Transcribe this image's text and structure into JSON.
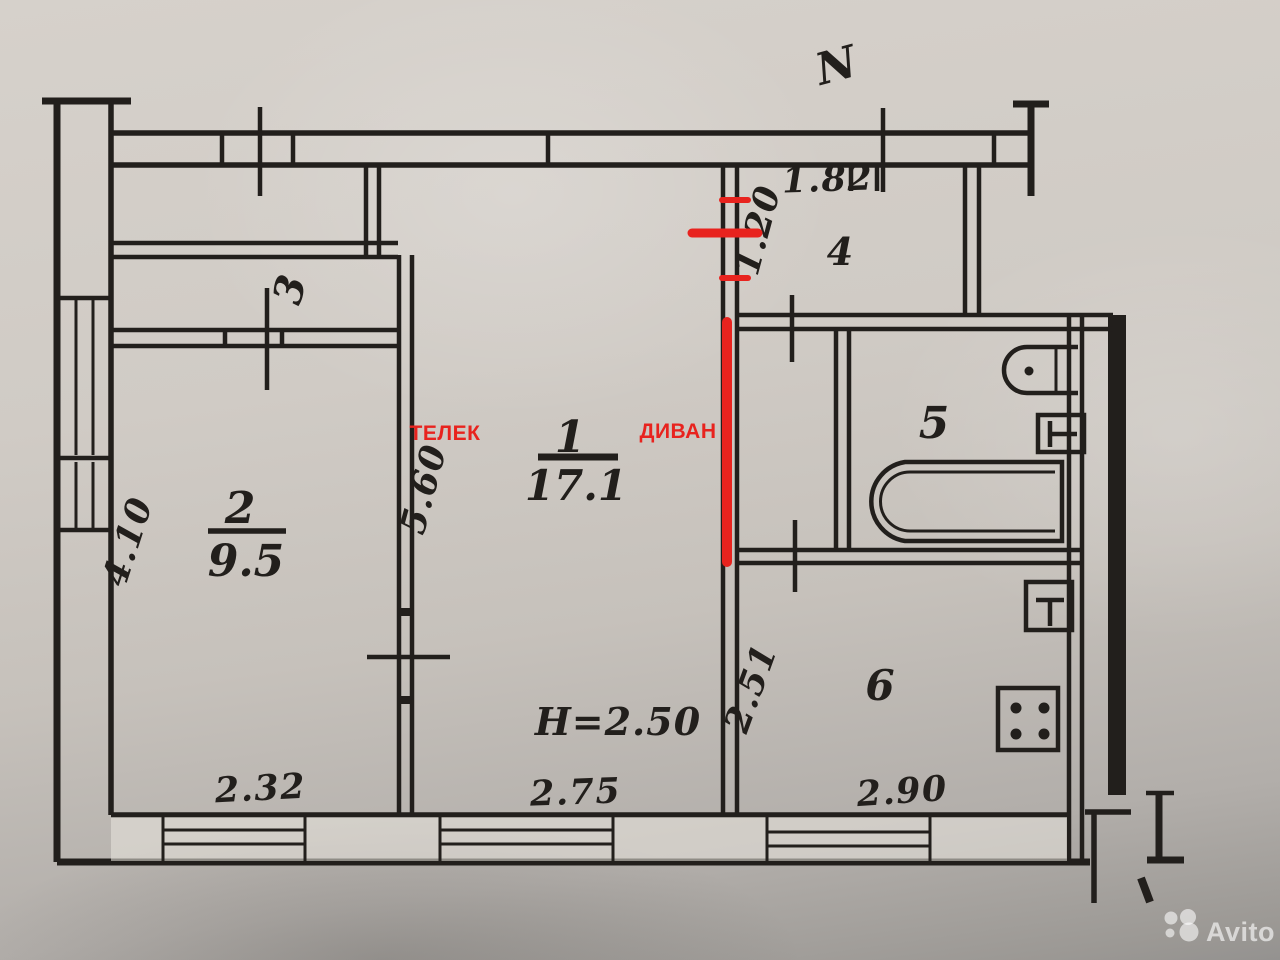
{
  "plan": {
    "compass": "N",
    "height_note": "H=2.50",
    "rooms": {
      "r1": {
        "number": "1",
        "area": "17.1"
      },
      "r2": {
        "number": "2",
        "area": "9.5"
      },
      "r3": {
        "number": "3"
      },
      "r4": {
        "number": "4"
      },
      "r5": {
        "number": "5"
      },
      "r6": {
        "number": "6"
      }
    },
    "dimensions": {
      "hall_width": "1.82",
      "hall_depth": "1.20",
      "room2_left_wall": "4.10",
      "room1_left_wall": "5.60",
      "kitchen_depth": "2.51",
      "room2_window": "2.32",
      "room1_window": "2.75",
      "kitchen_window": "2.90"
    },
    "fixtures": [
      "washbasin-icon",
      "toilet-icon",
      "bathtub-icon",
      "kitchen-sink-icon",
      "stove-icon"
    ]
  },
  "annotations": {
    "tv": "ТЕЛЕК",
    "sofa": "ДИВАН"
  },
  "watermark": {
    "brand": "Avito"
  },
  "colors": {
    "ink": "#221f1c",
    "red": "#e8231e",
    "paper": "#cfcac4"
  }
}
